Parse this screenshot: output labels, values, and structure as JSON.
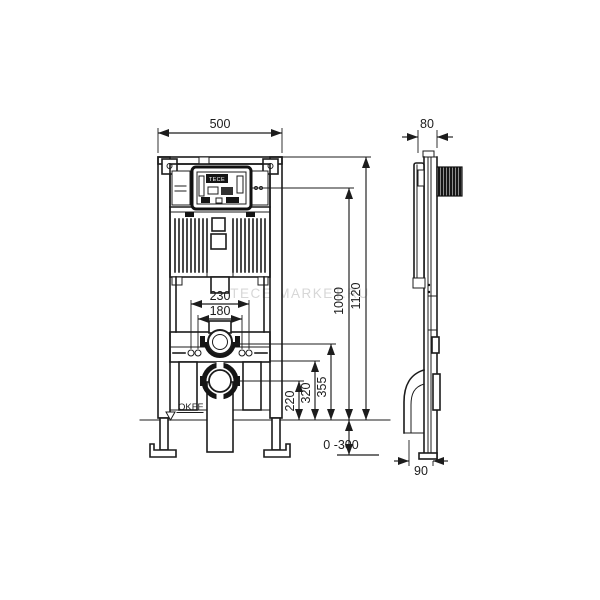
{
  "watermark": {
    "text": "TECE-MARKET.RU"
  },
  "module": {
    "brand": "TECE"
  },
  "floor": {
    "label": "OKFF"
  },
  "dimensions": {
    "front": {
      "width": "500",
      "fixing_outer": "230",
      "fixing_inner": "180",
      "total_height": "1120",
      "upper_height": "1000",
      "flush_height": "355",
      "outlet_top": "320",
      "outlet_center": "220",
      "adjust_range": "0 -300"
    },
    "side": {
      "depth": "80",
      "outlet_offset": "90"
    }
  }
}
